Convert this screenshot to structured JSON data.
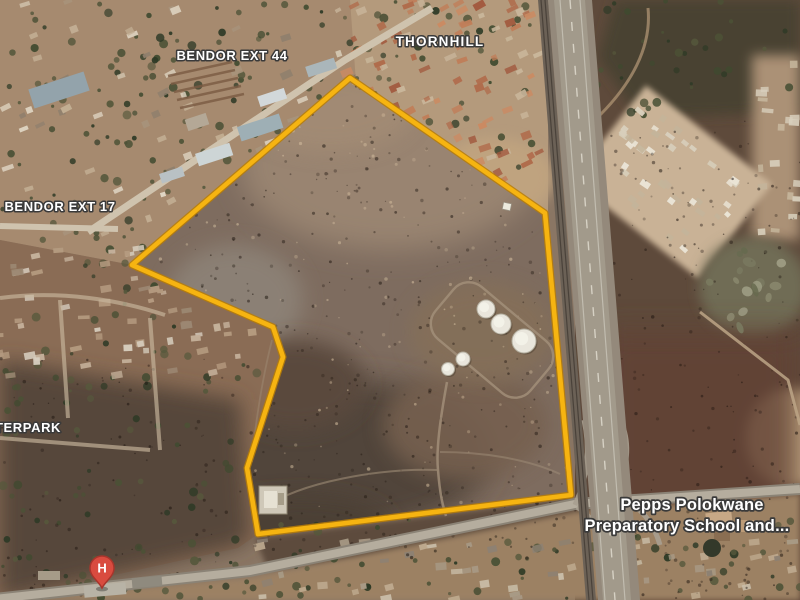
{
  "map": {
    "type": "satellite-imagery",
    "place_labels": [
      {
        "id": "bendor-ext-44",
        "text": "BENDOR EXT 44"
      },
      {
        "id": "thornhill",
        "text": "THORNHILL"
      },
      {
        "id": "bendor-ext-17",
        "text": "BENDOR EXT 17"
      },
      {
        "id": "sterpark",
        "text": "TERPARK"
      }
    ],
    "school_label": {
      "line1": "Pepps Polokwane",
      "line2": "Preparatory School and..."
    },
    "hospital_marker": {
      "glyph": "H"
    },
    "boundary": {
      "color": "#f6b411",
      "vertices": [
        [
          350,
          78
        ],
        [
          545,
          213
        ],
        [
          571,
          495
        ],
        [
          258,
          534
        ],
        [
          247,
          468
        ],
        [
          283,
          357
        ],
        [
          273,
          327
        ],
        [
          132,
          265
        ]
      ]
    },
    "tanks": [
      {
        "x": 486,
        "y": 309,
        "r": 9
      },
      {
        "x": 501,
        "y": 324,
        "r": 10
      },
      {
        "x": 524,
        "y": 341,
        "r": 12
      },
      {
        "x": 463,
        "y": 359,
        "r": 7
      },
      {
        "x": 448,
        "y": 369,
        "r": 6.5
      }
    ],
    "colors": {
      "boundary_yellow": "#f6b411",
      "veld": "#7e6c5f",
      "highway": "#9a9184",
      "hospital_pin": "#d94b3f",
      "label_text": "#ffffff"
    }
  }
}
